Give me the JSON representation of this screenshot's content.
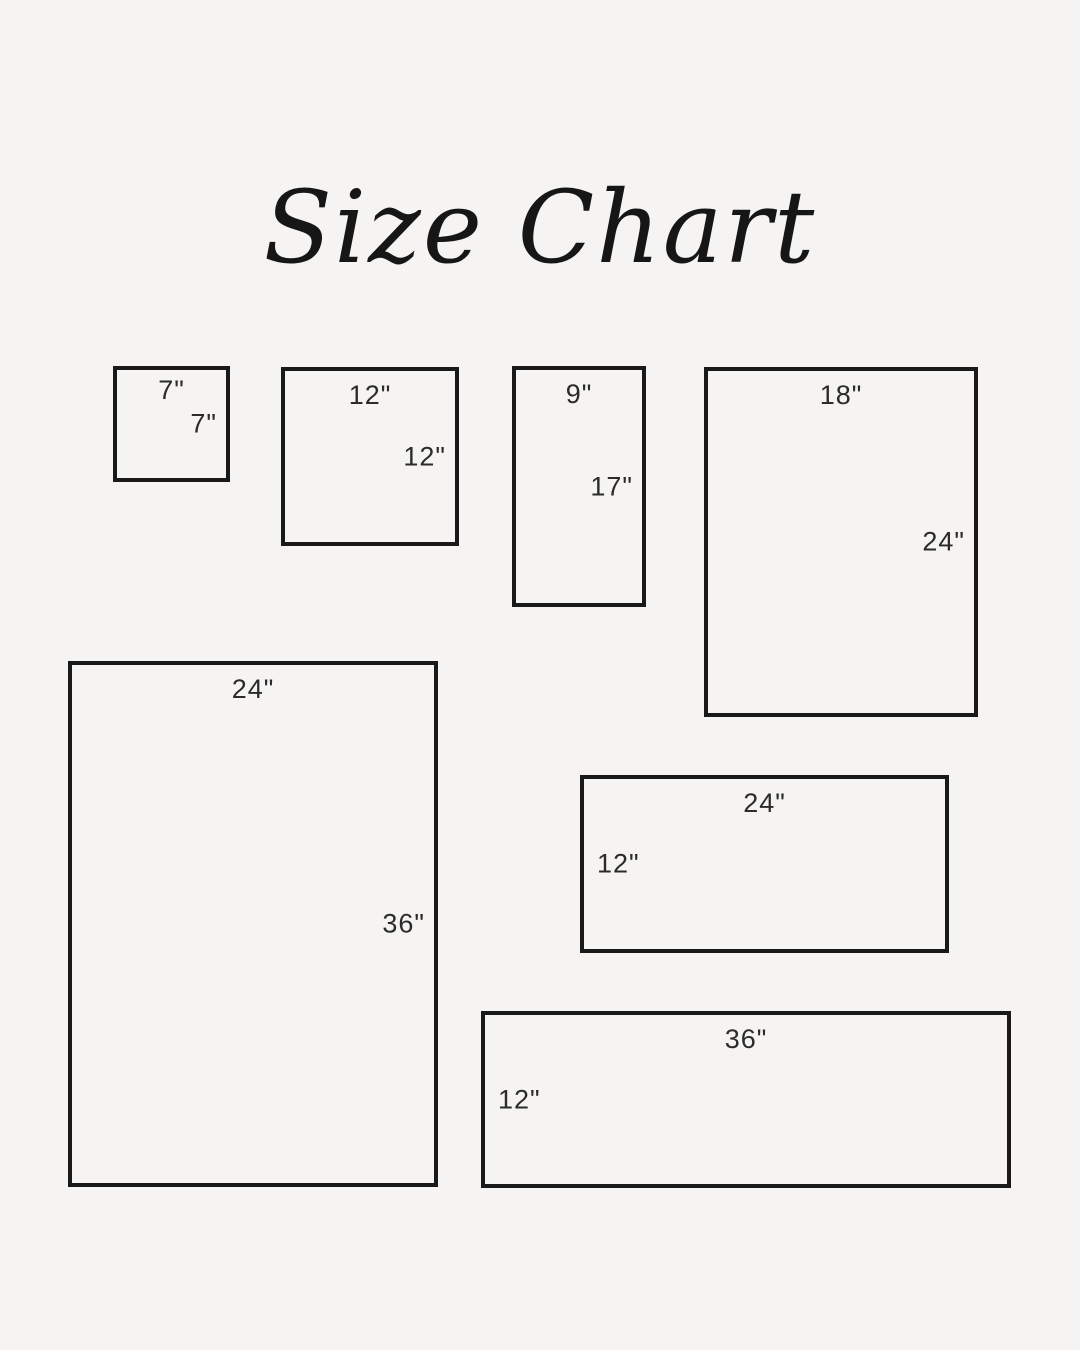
{
  "title": "Size Chart",
  "colors": {
    "background": "#f5f4f2",
    "line": "#191919",
    "label_text": "#2b2b2b"
  },
  "chart_data": {
    "type": "size-diagram",
    "title": "Size Chart",
    "unit": "inches",
    "sizes": [
      {
        "name": "7x7",
        "width_in": 7,
        "height_in": 7,
        "width_label": "7\"",
        "height_label": "7\"",
        "height_label_side": "right"
      },
      {
        "name": "12x12",
        "width_in": 12,
        "height_in": 12,
        "width_label": "12\"",
        "height_label": "12\"",
        "height_label_side": "right"
      },
      {
        "name": "9x17",
        "width_in": 9,
        "height_in": 17,
        "width_label": "9\"",
        "height_label": "17\"",
        "height_label_side": "right"
      },
      {
        "name": "18x24",
        "width_in": 18,
        "height_in": 24,
        "width_label": "18\"",
        "height_label": "24\"",
        "height_label_side": "right"
      },
      {
        "name": "24x36",
        "width_in": 24,
        "height_in": 36,
        "width_label": "24\"",
        "height_label": "36\"",
        "height_label_side": "right"
      },
      {
        "name": "24x12",
        "width_in": 24,
        "height_in": 12,
        "width_label": "24\"",
        "height_label": "12\"",
        "height_label_side": "left"
      },
      {
        "name": "36x12",
        "width_in": 36,
        "height_in": 12,
        "width_label": "36\"",
        "height_label": "12\"",
        "height_label_side": "left"
      }
    ]
  }
}
